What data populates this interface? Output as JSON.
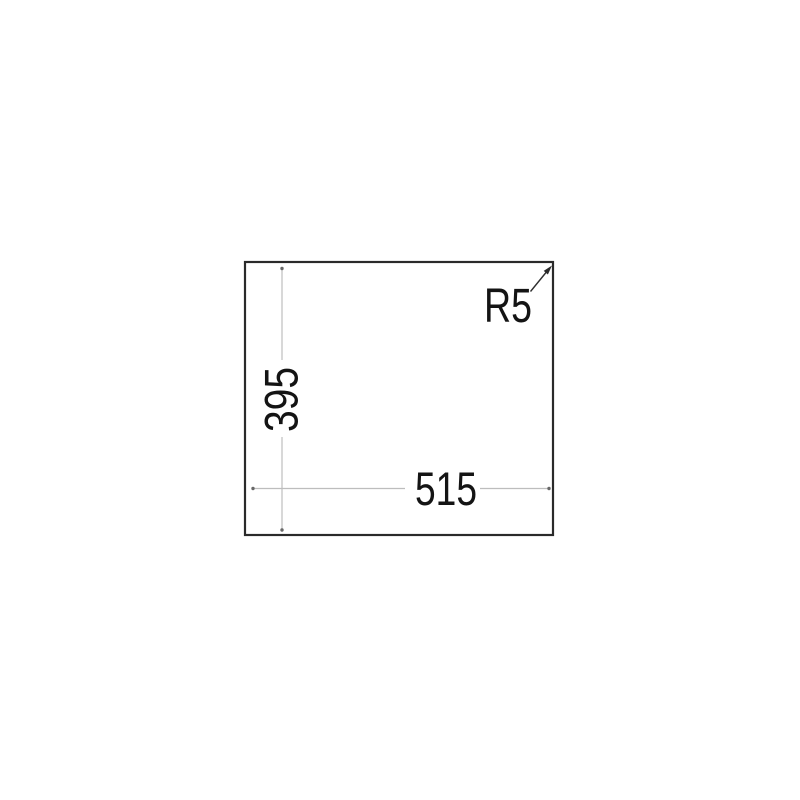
{
  "drawing": {
    "type": "technical-dimension-diagram",
    "labels": {
      "width_dim": "515",
      "height_dim": "395",
      "corner_radius": "R5"
    },
    "colors": {
      "background": "#ffffff",
      "outline": "#2a2a2a",
      "dimension_line": "#bdbdbd",
      "dimension_dot": "#686868",
      "leader": "#2e2e2e",
      "arrowhead": "#2a2a2a",
      "text": "#141414"
    }
  }
}
